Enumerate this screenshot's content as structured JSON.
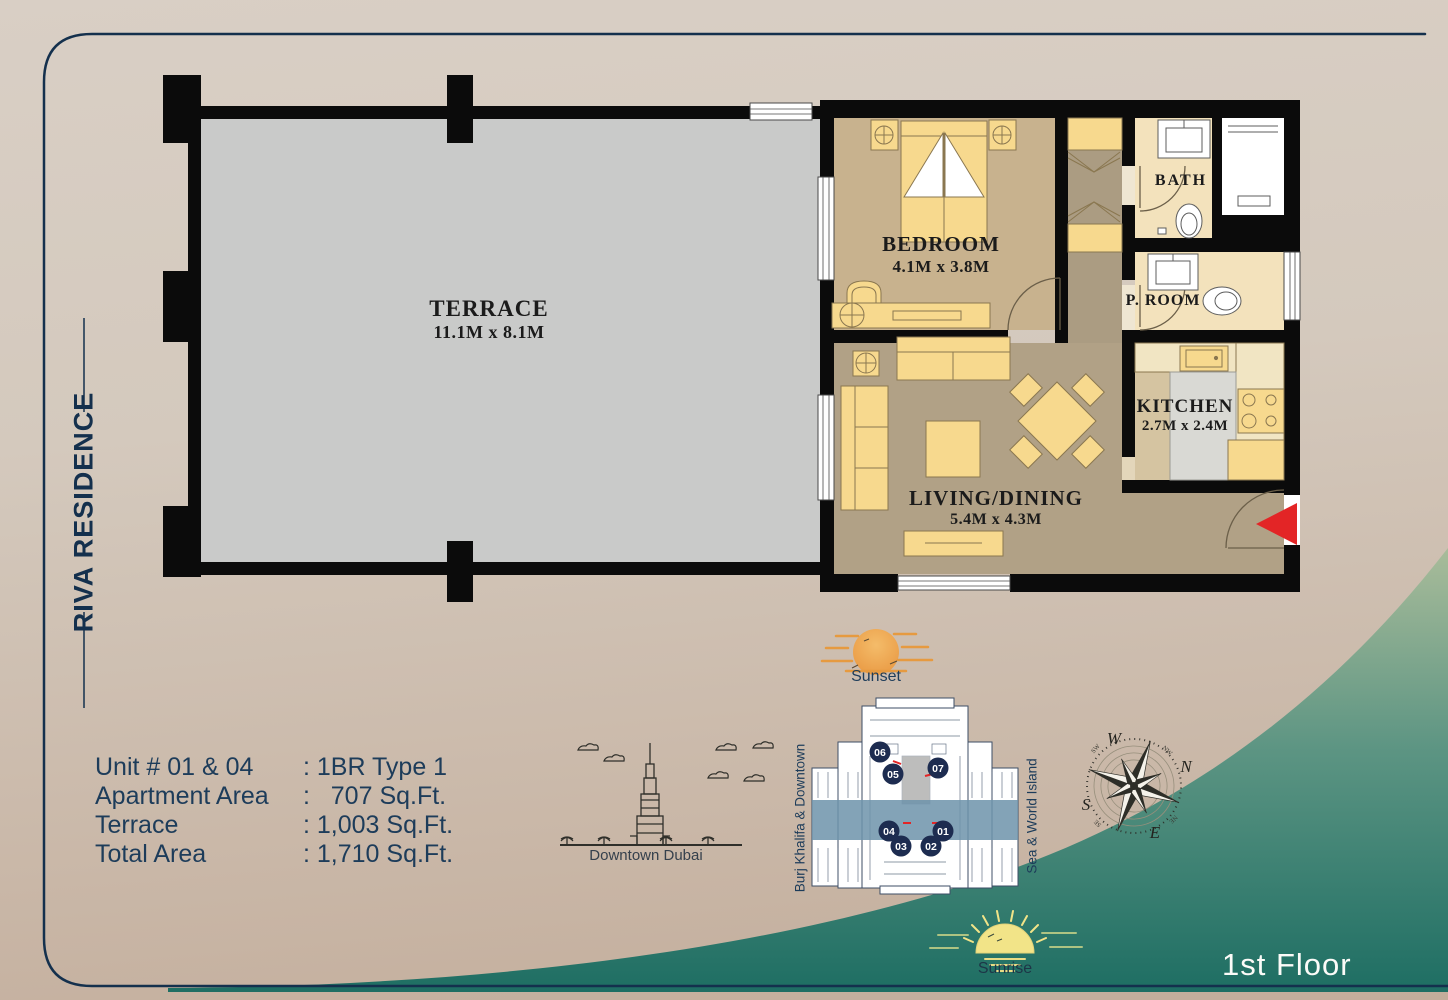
{
  "brand": {
    "name": "RIVA RESIDENCE"
  },
  "page": {
    "floor_label": "1st Floor"
  },
  "unit_info": {
    "rows": [
      {
        "label": "Unit # 01 & 04",
        "value": ": 1BR Type 1"
      },
      {
        "label": "Apartment Area",
        "value": ":   707 Sq.Ft."
      },
      {
        "label": "Terrace",
        "value": ": 1,003 Sq.Ft."
      },
      {
        "label": "Total Area",
        "value": ": 1,710 Sq.Ft."
      }
    ]
  },
  "floor_plan": {
    "terrace": {
      "name": "TERRACE",
      "dims": "11.1M x 8.1M"
    },
    "bedroom": {
      "name": "BEDROOM",
      "dims": "4.1M x 3.8M"
    },
    "bath": {
      "name": "BATH"
    },
    "proom": {
      "name": "P. ROOM"
    },
    "kitchen": {
      "name": "KITCHEN",
      "dims": "2.7M x 2.4M"
    },
    "living": {
      "name": "LIVING/DINING",
      "dims": "5.4M x 4.3M"
    }
  },
  "key_plan": {
    "left_label": "Burj Khalifa & Downtown",
    "right_label": "Sea & World Island",
    "units": {
      "u01": "01",
      "u02": "02",
      "u03": "03",
      "u04": "04",
      "u05": "05",
      "u06": "06",
      "u07": "07"
    }
  },
  "landmarks": {
    "skyline": "Downtown Dubai",
    "sunset": "Sunset",
    "sunrise": "Sunrise"
  },
  "compass": {
    "n": "N",
    "s": "S",
    "e": "E",
    "w": "W",
    "nw": "NW",
    "ne": "NE",
    "se": "SE",
    "sw": "SW"
  },
  "colors": {
    "navy": "#14304d",
    "wave_green": "#1e6e63",
    "highlight_blue": "#6d93aa",
    "arrow_red": "#e32526",
    "furniture_yellow": "#f7d98e",
    "terrace_gray": "#c9cac9",
    "wall_black": "#0b0b0b"
  }
}
